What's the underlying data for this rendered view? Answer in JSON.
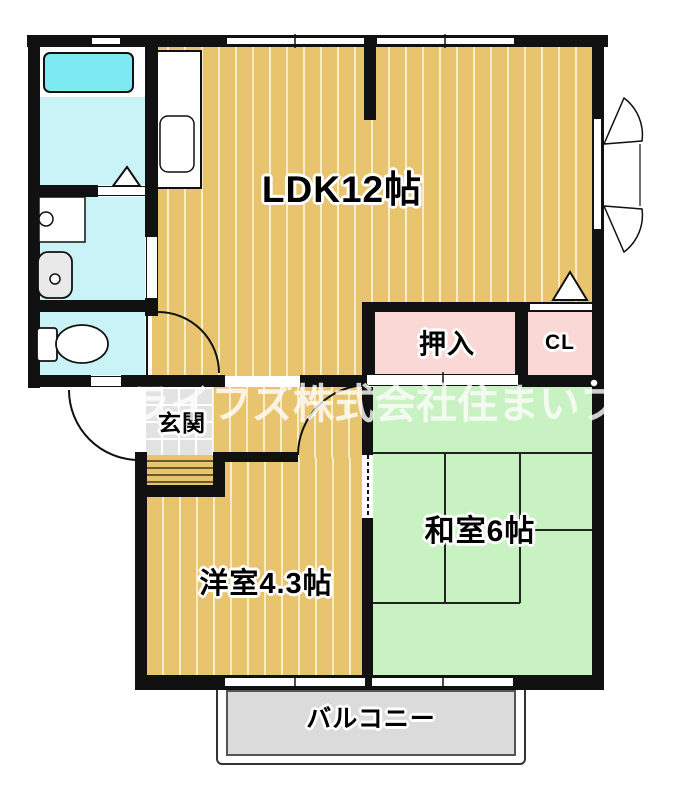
{
  "rooms": {
    "ldk": {
      "label": "LDK12帖"
    },
    "oshiire": {
      "label": "押入"
    },
    "cl": {
      "label": "CL"
    },
    "washitsu": {
      "label": "和室6帖"
    },
    "youshitsu": {
      "label": "洋室4.3帖"
    },
    "genkan": {
      "label": "玄関"
    },
    "balcony": {
      "label": "バルコニー"
    }
  },
  "watermark": {
    "text": "ーライフズ株式会社住まいプ"
  },
  "fixtures": [
    "bathtub",
    "washer-pan",
    "washbasin",
    "toilet",
    "kitchen-sink",
    "entry-door-arc",
    "ldk-door-arc",
    "bedroom-door-arc",
    "sliding-door",
    "casement-window",
    "triangle-marker"
  ],
  "colors": {
    "wall": "#111111",
    "ldk_floor": "#e8c46f",
    "floor_stripe": "#f7eec8",
    "tatami": "#c8f2c2",
    "closet_pink": "#f9d8d5",
    "wet_area": "#c9f3f6",
    "bathtub": "#7de9f1",
    "balcony": "#dbdbdb",
    "genkan_tile": "#e3e3e3",
    "watermark_white": "#ffffff"
  }
}
